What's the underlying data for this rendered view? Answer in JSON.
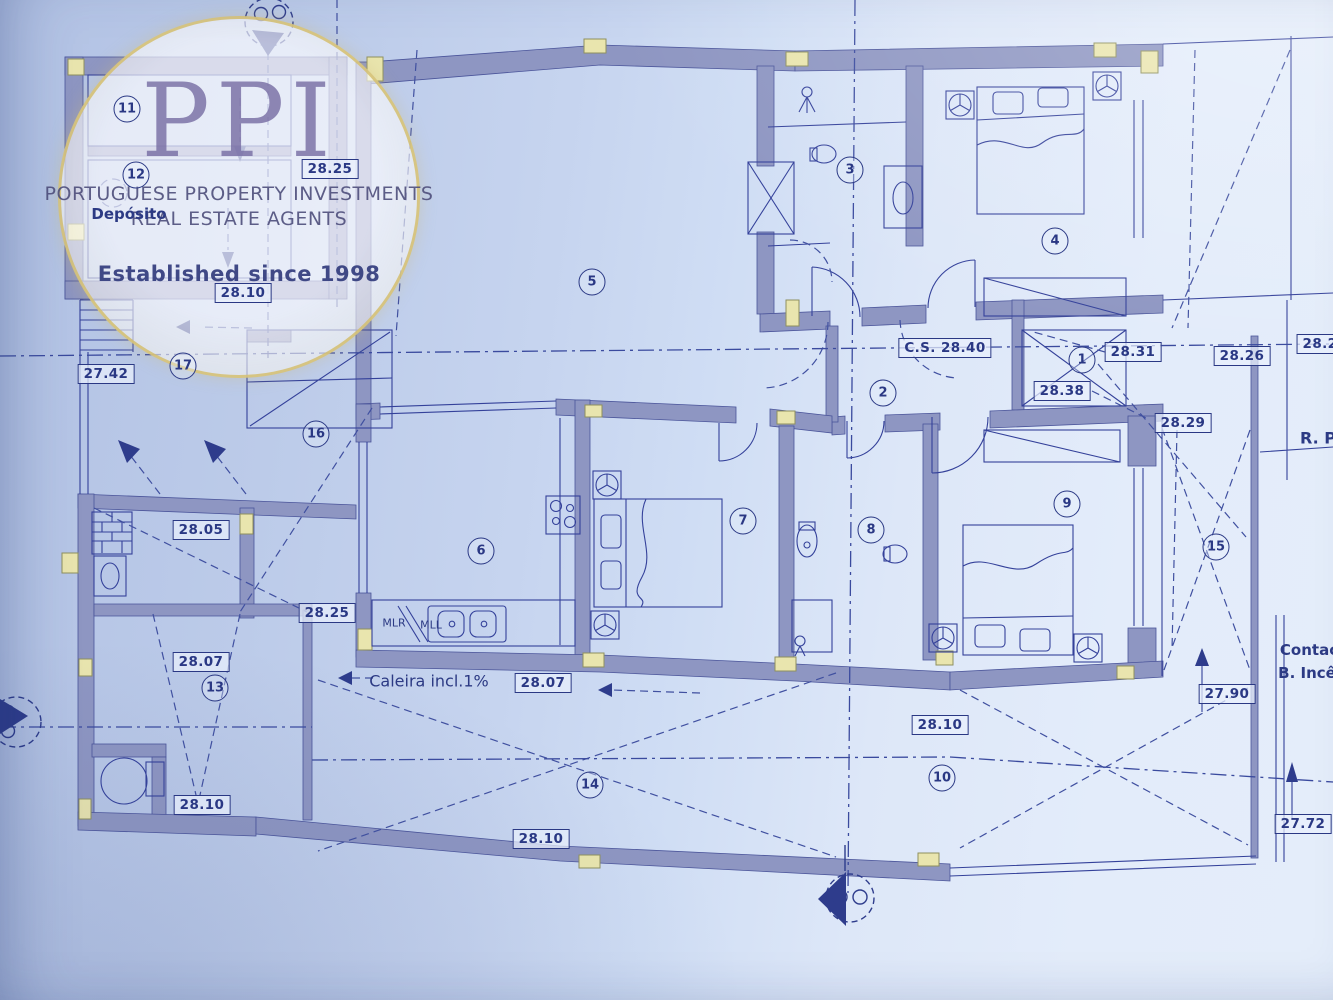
{
  "watermark": {
    "logo_text": "PPI",
    "line1": "PORTUGUESE PROPERTY INVESTMENTS",
    "line2": "REAL ESTATE AGENTS",
    "tagline": "Established since 1998"
  },
  "plan": {
    "colors": {
      "ink": "#2a3884",
      "wall": "#8e96c2",
      "line": "#34419a",
      "column": "#e9e5ae",
      "paper": "#c9d7f1"
    },
    "room_numbers": [
      {
        "n": "1",
        "x": 1082,
        "y": 360
      },
      {
        "n": "2",
        "x": 883,
        "y": 393
      },
      {
        "n": "3",
        "x": 850,
        "y": 170
      },
      {
        "n": "4",
        "x": 1055,
        "y": 241
      },
      {
        "n": "5",
        "x": 592,
        "y": 282
      },
      {
        "n": "6",
        "x": 481,
        "y": 551
      },
      {
        "n": "7",
        "x": 743,
        "y": 521
      },
      {
        "n": "8",
        "x": 871,
        "y": 530
      },
      {
        "n": "9",
        "x": 1067,
        "y": 504
      },
      {
        "n": "10",
        "x": 942,
        "y": 778
      },
      {
        "n": "11",
        "x": 127,
        "y": 109
      },
      {
        "n": "12",
        "x": 136,
        "y": 175
      },
      {
        "n": "13",
        "x": 215,
        "y": 688
      },
      {
        "n": "14",
        "x": 590,
        "y": 785
      },
      {
        "n": "15",
        "x": 1216,
        "y": 547
      },
      {
        "n": "16",
        "x": 316,
        "y": 434
      },
      {
        "n": "17",
        "x": 183,
        "y": 366
      }
    ],
    "elevation_labels": [
      {
        "text": "28.25",
        "x": 330,
        "y": 169
      },
      {
        "text": "28.10",
        "x": 243,
        "y": 293
      },
      {
        "text": "27.42",
        "x": 106,
        "y": 374
      },
      {
        "text": "28.05",
        "x": 201,
        "y": 530
      },
      {
        "text": "28.25",
        "x": 327,
        "y": 613
      },
      {
        "text": "28.07",
        "x": 201,
        "y": 662
      },
      {
        "text": "28.10",
        "x": 202,
        "y": 805
      },
      {
        "text": "28.07",
        "x": 543,
        "y": 683
      },
      {
        "text": "28.10",
        "x": 541,
        "y": 839
      },
      {
        "text": "28.10",
        "x": 940,
        "y": 725
      },
      {
        "text": "C.S. 28.40",
        "x": 945,
        "y": 348
      },
      {
        "text": "28.31",
        "x": 1133,
        "y": 352
      },
      {
        "text": "28.26",
        "x": 1242,
        "y": 356
      },
      {
        "text": "28.2",
        "x": 1320,
        "y": 344
      },
      {
        "text": "28.38",
        "x": 1062,
        "y": 391
      },
      {
        "text": "28.29",
        "x": 1183,
        "y": 423
      },
      {
        "text": "27.90",
        "x": 1227,
        "y": 694
      },
      {
        "text": "27.72",
        "x": 1303,
        "y": 824
      }
    ],
    "annotations": [
      {
        "text": "Depósito",
        "x": 129,
        "y": 214,
        "size": 15,
        "bold": true
      },
      {
        "text": "Caleira incl.1%",
        "x": 429,
        "y": 681,
        "size": 16,
        "bold": false
      },
      {
        "text": "MLR",
        "x": 394,
        "y": 623,
        "size": 11,
        "bold": false
      },
      {
        "text": "MLL",
        "x": 431,
        "y": 625,
        "size": 11,
        "bold": false
      },
      {
        "text": "R. P",
        "x": 1318,
        "y": 438,
        "size": 16,
        "bold": true
      },
      {
        "text": "Contac",
        "x": 1309,
        "y": 650,
        "size": 15,
        "bold": true
      },
      {
        "text": "B. Incê",
        "x": 1307,
        "y": 673,
        "size": 15,
        "bold": true
      }
    ]
  }
}
